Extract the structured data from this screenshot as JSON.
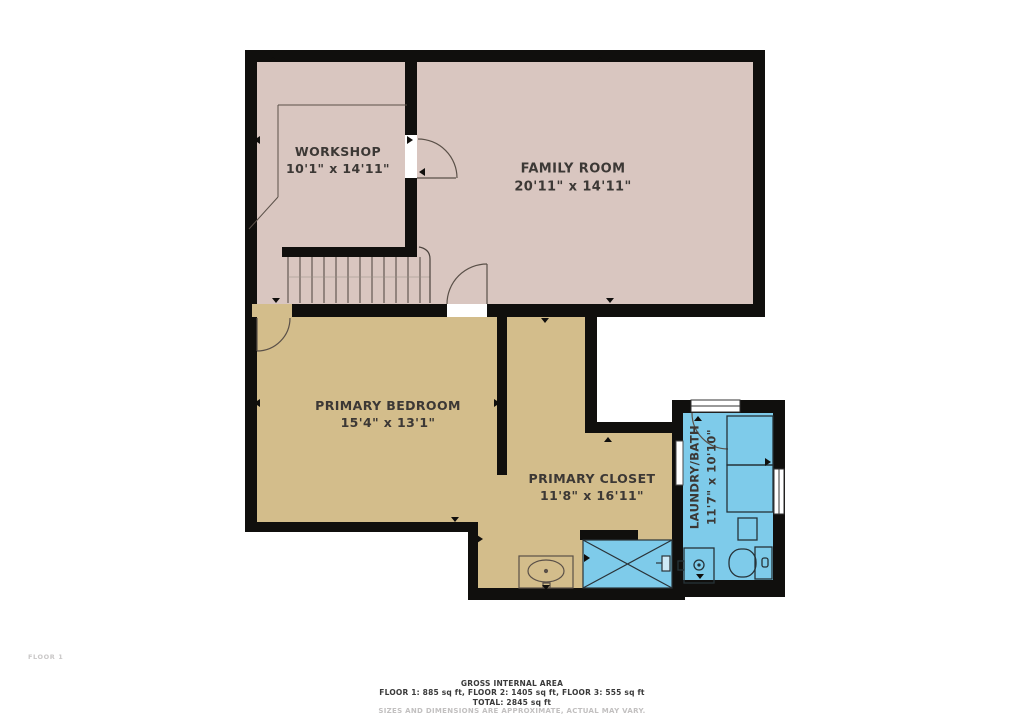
{
  "plan": {
    "floor_label": "FLOOR 1",
    "rooms": {
      "workshop": {
        "name": "WORKSHOP",
        "dims": "10'1\" x 14'11\""
      },
      "family_room": {
        "name": "FAMILY ROOM",
        "dims": "20'11\" x 14'11\""
      },
      "primary_bedroom": {
        "name": "PRIMARY BEDROOM",
        "dims": "15'4\" x 13'1\""
      },
      "primary_closet": {
        "name": "PRIMARY CLOSET",
        "dims": "11'8\" x 16'11\""
      },
      "laundry_bath": {
        "name": "LAUNDRY/BATH",
        "dims": "11'7\" x 10'10\""
      }
    },
    "fixtures": [
      "stairs",
      "washer-dryer",
      "toilet",
      "laundry-sink",
      "vanity-sink",
      "shower",
      "windows",
      "doors"
    ],
    "footer": {
      "title": "GROSS INTERNAL AREA",
      "areas": "FLOOR 1: 885 sq ft, FLOOR 2: 1405 sq ft, FLOOR 3: 555 sq ft",
      "total": "TOTAL: 2845 sq ft",
      "disclaimer": "SIZES AND DIMENSIONS ARE APPROXIMATE, ACTUAL MAY VARY."
    }
  },
  "colors": {
    "wall": "#100f0d",
    "floor-pink": "#d9c6c0",
    "floor-tan": "#d3bd8b",
    "floor-blue": "#7ecbea",
    "label": "#3c3835",
    "line": "#5a5048",
    "fixture": "#263238",
    "footer-text": "#3a3a3a",
    "footer-muted": "#c2c0c0",
    "floor-label": "#c9c7c7"
  }
}
